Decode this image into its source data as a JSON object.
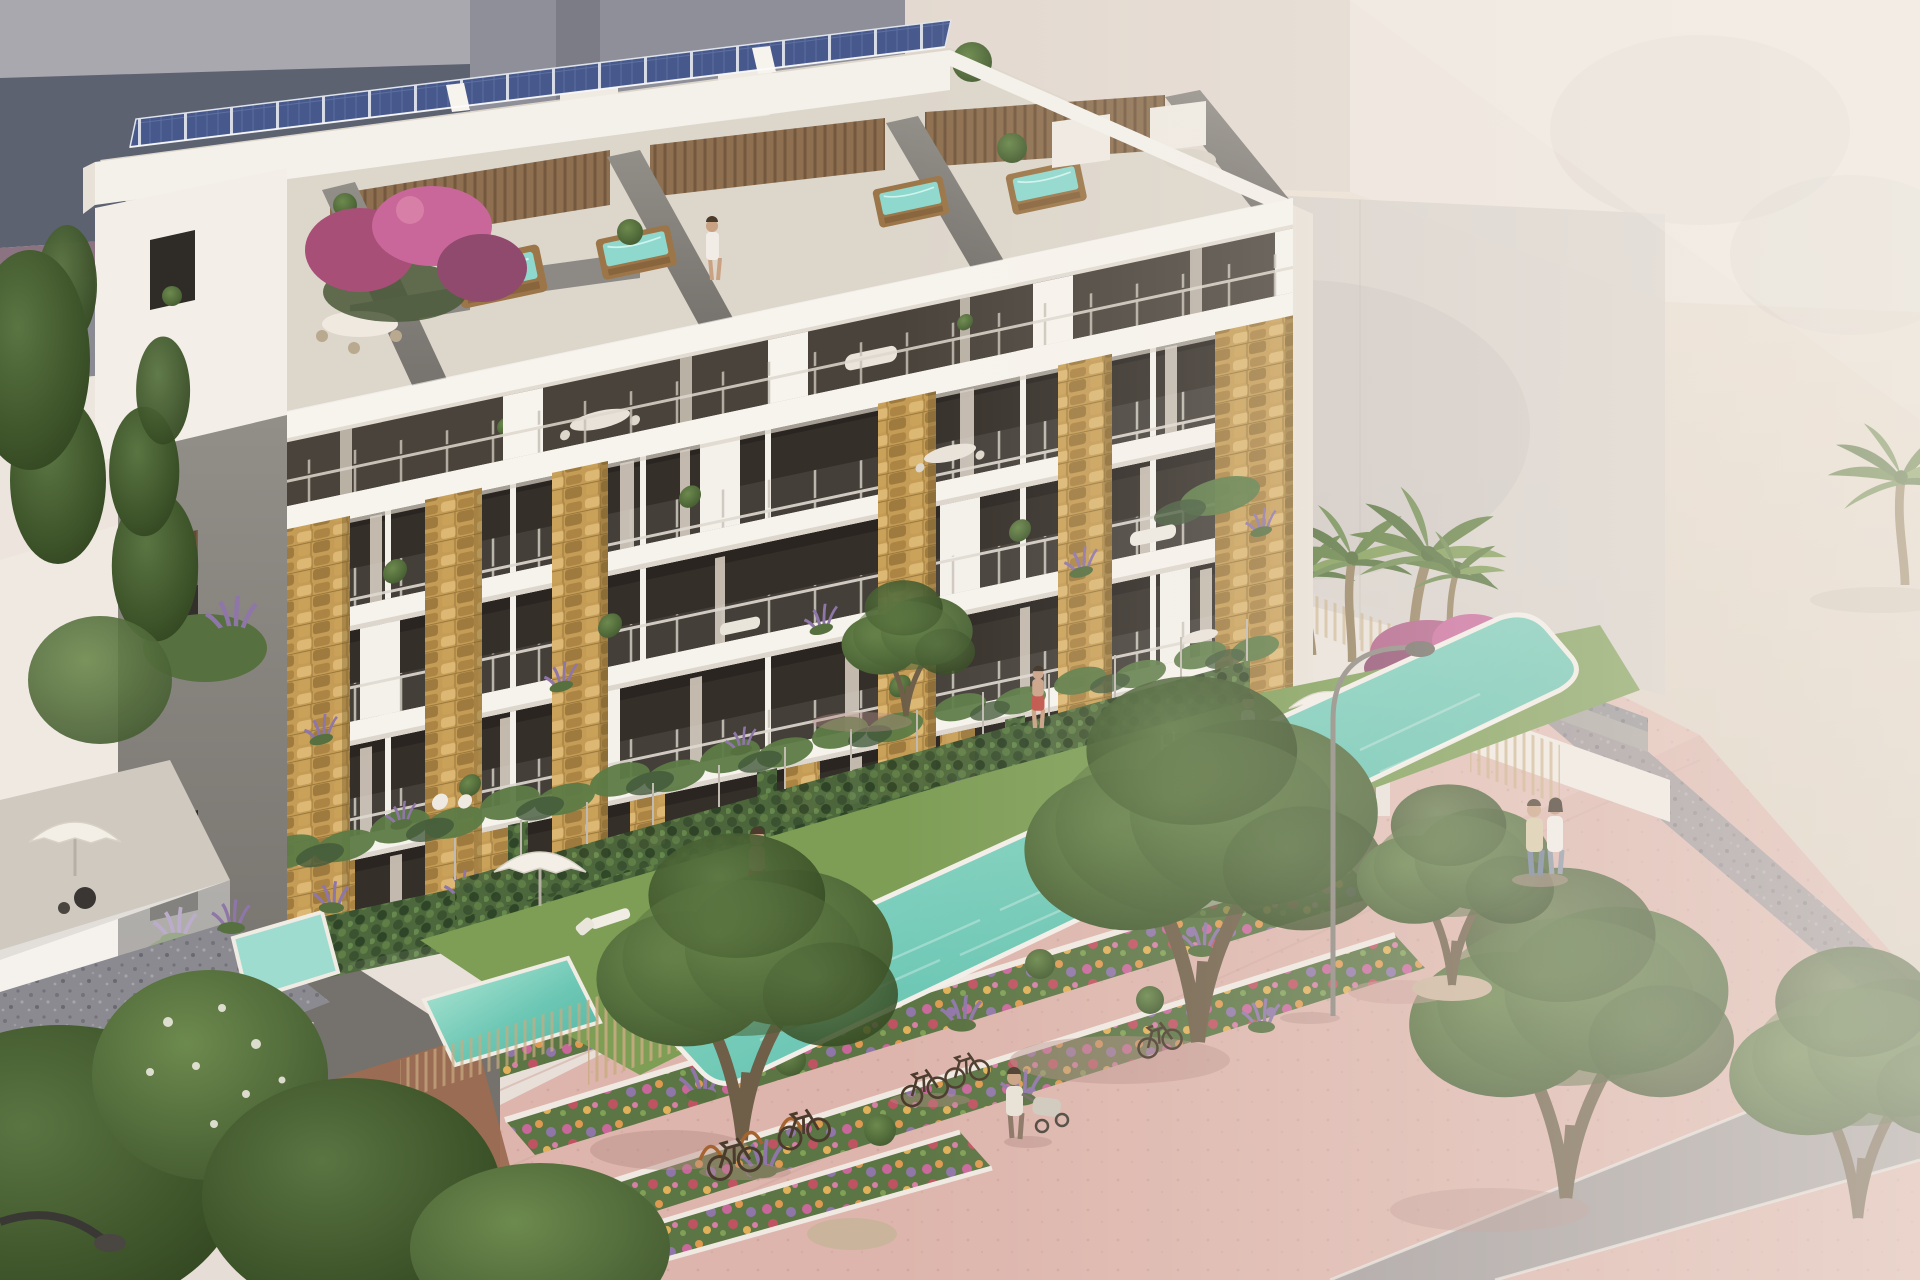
{
  "scene": {
    "kind": "architectural-rendering",
    "subject": "modern seafront apartment building with rooftop solar panels, penthouse hot tubs, communal lap pool, terraced flower beds and pink beach promenade",
    "camera": "elevated aerial three-quarter view",
    "lighting": "hazy warm daylight"
  },
  "inventory": {
    "building_floors_visible": 6,
    "rooftop_hot_tubs": 4,
    "solar_panel_row": true,
    "stone_clad_pillars": 6,
    "communal_pool": 1,
    "plunge_pools": 2,
    "parasols": 3,
    "sun_loungers": 4,
    "flower_terrace_rows": 3,
    "bicycles": 5,
    "street_lamps": 2,
    "palm_trees": 5,
    "promenade_trees": 6,
    "people": [
      "man-walking-on-lawn",
      "man-beside-pool",
      "woman-on-lawn",
      "swimmer-in-pool",
      "couple-on-promenade",
      "person-with-stroller",
      "woman-on-roof-terrace"
    ]
  },
  "palette": {
    "sky": "#f0e9e2",
    "skyDeep": "#e6ded6",
    "sea": "#5d6271",
    "seaPurple": "#7f6678",
    "bgGrayLight": "#a9a8ae",
    "bgGray": "#8f8f99",
    "bgGrayShade": "#6f6f79",
    "creamA": "#e3d9d0",
    "creamB": "#d8d2cc",
    "creamC": "#eee6de",
    "sand": "#ece1d5",
    "sandDeep": "#dbcec0",
    "buildingWhite": "#f4f0ea",
    "slabShade": "#d8d1c8",
    "windowDark": "#352f29",
    "interiorDark": "#49433b",
    "curtain": "#d7cdc0",
    "concrete": "#928e88",
    "concreteDark": "#75716c",
    "stoneBase": "#c59c55",
    "woodSlat": "#8a6b4a",
    "tubWood": "#9c7648",
    "tubWater": "#8fd8ce",
    "deck": "#ddd6cb",
    "solarBlue": "#47588c",
    "lawn": "#7e9e56",
    "hedge": "#4d683c",
    "ivy": "#5d7c46",
    "ivyDark": "#42593a",
    "poolLight": "#b9ead9",
    "poolMid": "#6cc7b4",
    "poolDeep": "#55b3a2",
    "lavender": "#8f76a8",
    "flowerBase": "#5c7544",
    "promenade": "#ddb5ac",
    "promenadeLight": "#e8c5bc",
    "road": "#a39c9c",
    "gravel": "#8b8a90",
    "treeLight": "#6d8a4e",
    "treeDark": "#42592f",
    "trunk": "#6f5f48",
    "palmGreen": "#5f7d3f",
    "palmLight": "#7d9a52",
    "palmTrunk": "#94805d",
    "skin": "#c9a183",
    "white": "#f4f1ea",
    "rampBrown": "#9c6b52",
    "shadow": "#b78f88",
    "redShorts": "#c05348"
  }
}
